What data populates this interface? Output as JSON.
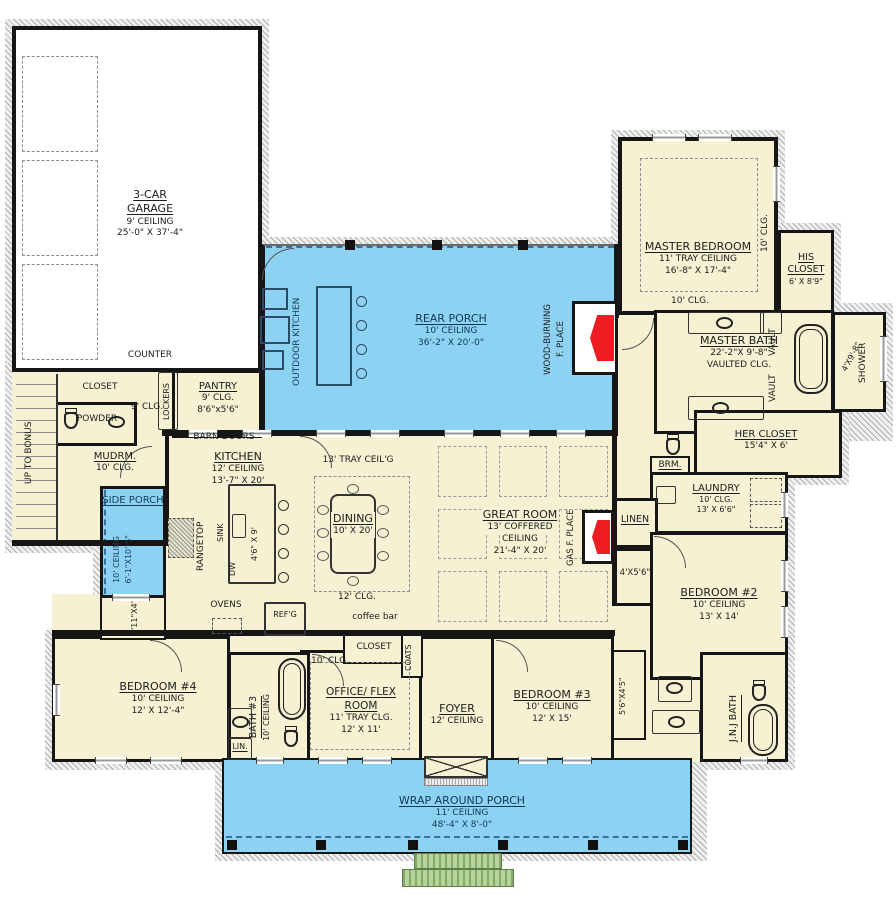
{
  "colors": {
    "room_fill": "#f6f1d2",
    "porch_fill": "#8dd2f3",
    "fireplace_red": "#ee1c23",
    "steps_green": "#b7d49d",
    "wall": "#161616"
  },
  "rooms": {
    "garage": {
      "name": "3-CAR GARAGE",
      "lines": [
        "9' CEILING",
        "25'-0\" X 37'-4\""
      ]
    },
    "counter": {
      "name": "COUNTER"
    },
    "stair_closet": {
      "name": "CLOSET"
    },
    "stairs": {
      "name": "UP TO BONUS"
    },
    "powder": {
      "name": "POWDER"
    },
    "mudroom": {
      "name": "MUDRM.",
      "lines": [
        "10' CLG."
      ]
    },
    "mud_hall": {
      "name": "9' CLG."
    },
    "lockers": {
      "name": "LOCKERS"
    },
    "pantry": {
      "name": "PANTRY",
      "lines": [
        "9' CLG.",
        "8'6\"x5'6\""
      ]
    },
    "barn_doors": {
      "name": "BARN DOORS"
    },
    "outdoor_kitchen": {
      "name": "OUTDOOR KITCHEN"
    },
    "rear_porch": {
      "name": "REAR PORCH",
      "lines": [
        "10' CEILING",
        "36'-2\" X 20'-0\""
      ]
    },
    "wood_fireplace": {
      "lines": [
        "WOOD-BURNING",
        "F. PLACE"
      ]
    },
    "master_bedroom": {
      "name": "MASTER BEDROOM",
      "lines": [
        "11' TRAY CEILING",
        "16'-8\" X 17'-4\""
      ],
      "clg_side": "10' CLG.",
      "clg_bottom": "10' CLG."
    },
    "his_closet": {
      "name": "HIS CLOSET",
      "lines": [
        "6' X 8'9\""
      ]
    },
    "master_bath": {
      "name": "MASTER BATH",
      "lines": [
        "22'-2\"X 9'-8\"",
        "VAULTED CLG."
      ],
      "vault": "VAULT",
      "shower": "SHOWER",
      "shower_dim": "4'X9'-8\""
    },
    "her_closet": {
      "name": "HER CLOSET",
      "lines": [
        "15'4\" X 6'"
      ]
    },
    "brm": {
      "name": "BRM."
    },
    "laundry": {
      "name": "LAUNDRY",
      "lines": [
        "10' CLG.",
        "13' X 6'6\""
      ]
    },
    "linen": {
      "name": "LINEN"
    },
    "hall_closet": {
      "name": "4'X5'6\""
    },
    "bedroom2": {
      "name": "BEDROOM #2",
      "lines": [
        "10' CEILING",
        "13' X 14'"
      ]
    },
    "jnj_bath": {
      "name": "J.N.J BATH"
    },
    "bed3_closet": {
      "name": "5'6\"X4'5\""
    },
    "bedroom3": {
      "name": "BEDROOM #3",
      "lines": [
        "10' CEILING",
        "12' X 15'"
      ]
    },
    "foyer": {
      "name": "FOYER",
      "lines": [
        "12' CEILING"
      ]
    },
    "office": {
      "name": "OFFICE/ FLEX ROOM",
      "lines": [
        "11' TRAY CLG.",
        "12' X 11'"
      ],
      "clg": "10' CLG."
    },
    "office_closet": {
      "name": "CLOSET"
    },
    "coats": {
      "name": "COATS"
    },
    "bath3": {
      "name": "BATH #3",
      "lines": [
        "10' CEILING"
      ]
    },
    "lin": {
      "name": "LIN."
    },
    "bedroom4": {
      "name": "BEDROOM #4",
      "lines": [
        "10' CEILING",
        "12' X 12'-4\""
      ]
    },
    "bed4_closet": {
      "name": "5'11\"X4'"
    },
    "side_porch": {
      "name": "SIDE PORCH",
      "lines": [
        "10' CEILING",
        "6'-1\"X10'-5\""
      ]
    },
    "kitchen": {
      "name": "KITCHEN",
      "lines": [
        "12' CEILING",
        "13'-7\" X 20'"
      ]
    },
    "rangetop": {
      "name": "RANGETOP"
    },
    "sink": {
      "name": "SINK"
    },
    "dw": {
      "name": "DW"
    },
    "island": {
      "name": "4'6\" X 9'"
    },
    "ovens": {
      "name": "OVENS"
    },
    "refg": {
      "name": "REF'G"
    },
    "dining": {
      "name": "DINING",
      "lines": [
        "10' X 20'"
      ],
      "tray": "13' TRAY CEIL'G",
      "clg": "12' CLG.",
      "coffee": "coffee bar"
    },
    "great_room": {
      "name": "GREAT ROOM",
      "lines": [
        "13' COFFERED",
        "CEILING",
        "21'-4\" X 20'"
      ]
    },
    "gas_fireplace": {
      "name": "GAS F. PLACE"
    },
    "wrap_porch": {
      "name": "WRAP AROUND PORCH",
      "lines": [
        "11' CEILING",
        "48'-4\" X 8'-0\""
      ]
    }
  }
}
